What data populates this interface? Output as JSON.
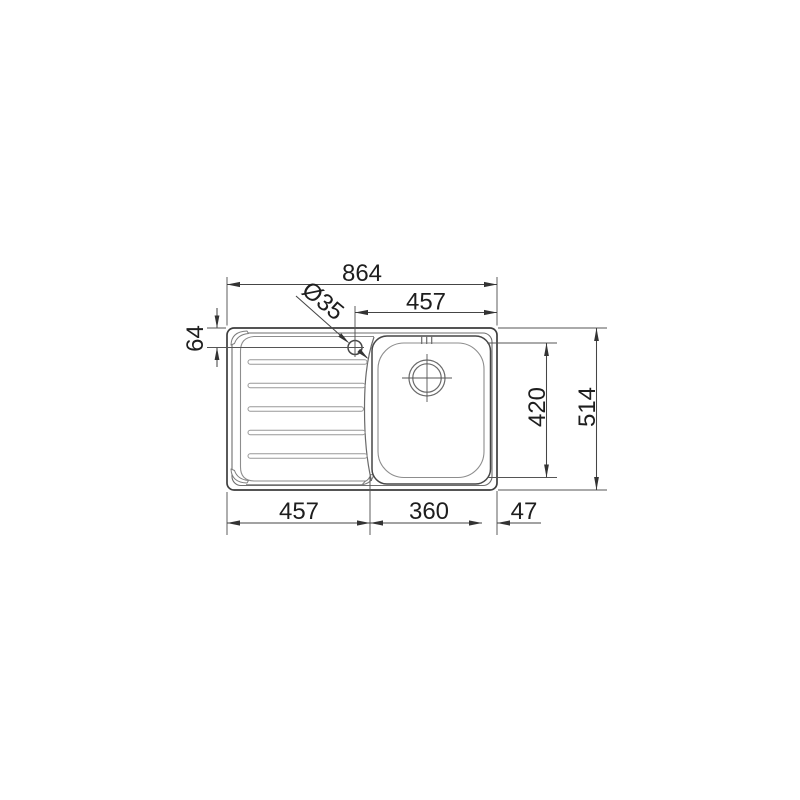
{
  "drawing": {
    "type": "technical-dimension-drawing",
    "subject": "inset kitchen sink, top view, single bowl with left drainer",
    "units": "mm",
    "colors": {
      "background": "#ffffff",
      "outline_dark": "#3d3d3d",
      "outline_light": "#8d8d8d",
      "dimension_line": "#454545",
      "text": "#1e1e1e"
    },
    "dims": {
      "overall_width": "864",
      "hole_to_right_edge": "457",
      "faucet_hole_diameter": "Ø35",
      "hole_offset_from_top": "64",
      "bowl_inner_length": "420",
      "overall_depth": "514",
      "drainer_width": "457",
      "bowl_width": "360",
      "right_margin": "47"
    }
  }
}
